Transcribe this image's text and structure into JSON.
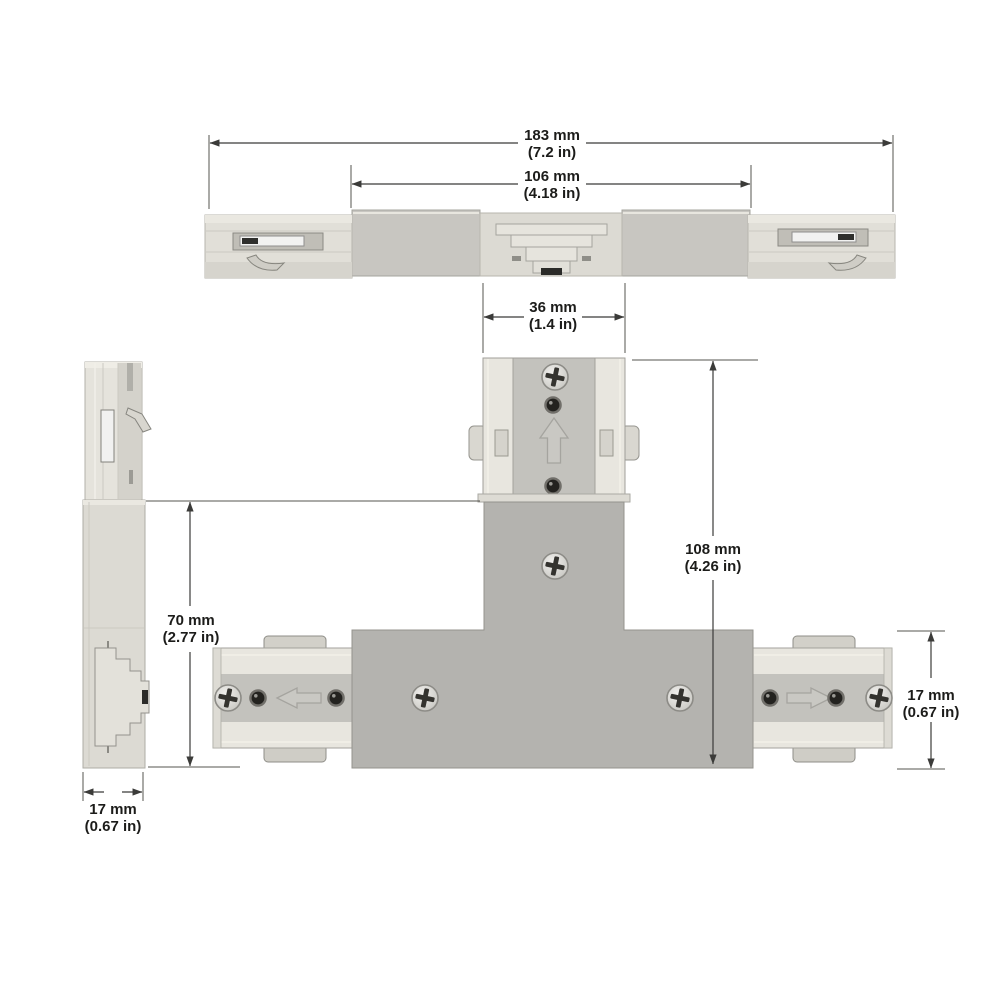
{
  "dimensions": {
    "overall_length": {
      "mm": "183 mm",
      "in": "(7.2 in)"
    },
    "center_length": {
      "mm": "106 mm",
      "in": "(4.18 in)"
    },
    "stem_width": {
      "mm": "36 mm",
      "in": "(1.4 in)"
    },
    "overall_height": {
      "mm": "108 mm",
      "in": "(4.26 in)"
    },
    "side_body_height": {
      "mm": "70 mm",
      "in": "(2.77 in)"
    },
    "side_profile_width": {
      "mm": "17 mm",
      "in": "(0.67 in)"
    },
    "track_end_height": {
      "mm": "17 mm",
      "in": "(0.67 in)"
    }
  },
  "colors": {
    "background": "#ffffff",
    "dimension_line": "#3b3b39",
    "label_text": "#1c1c1a",
    "body_gray": "#b4b3af",
    "housing_gray": "#c8c6c1",
    "track_light": "#e8e6df",
    "band_gray": "#c3c2bd",
    "metal_chrome": "#f2f2f1",
    "slot_black": "#2b2b29"
  }
}
